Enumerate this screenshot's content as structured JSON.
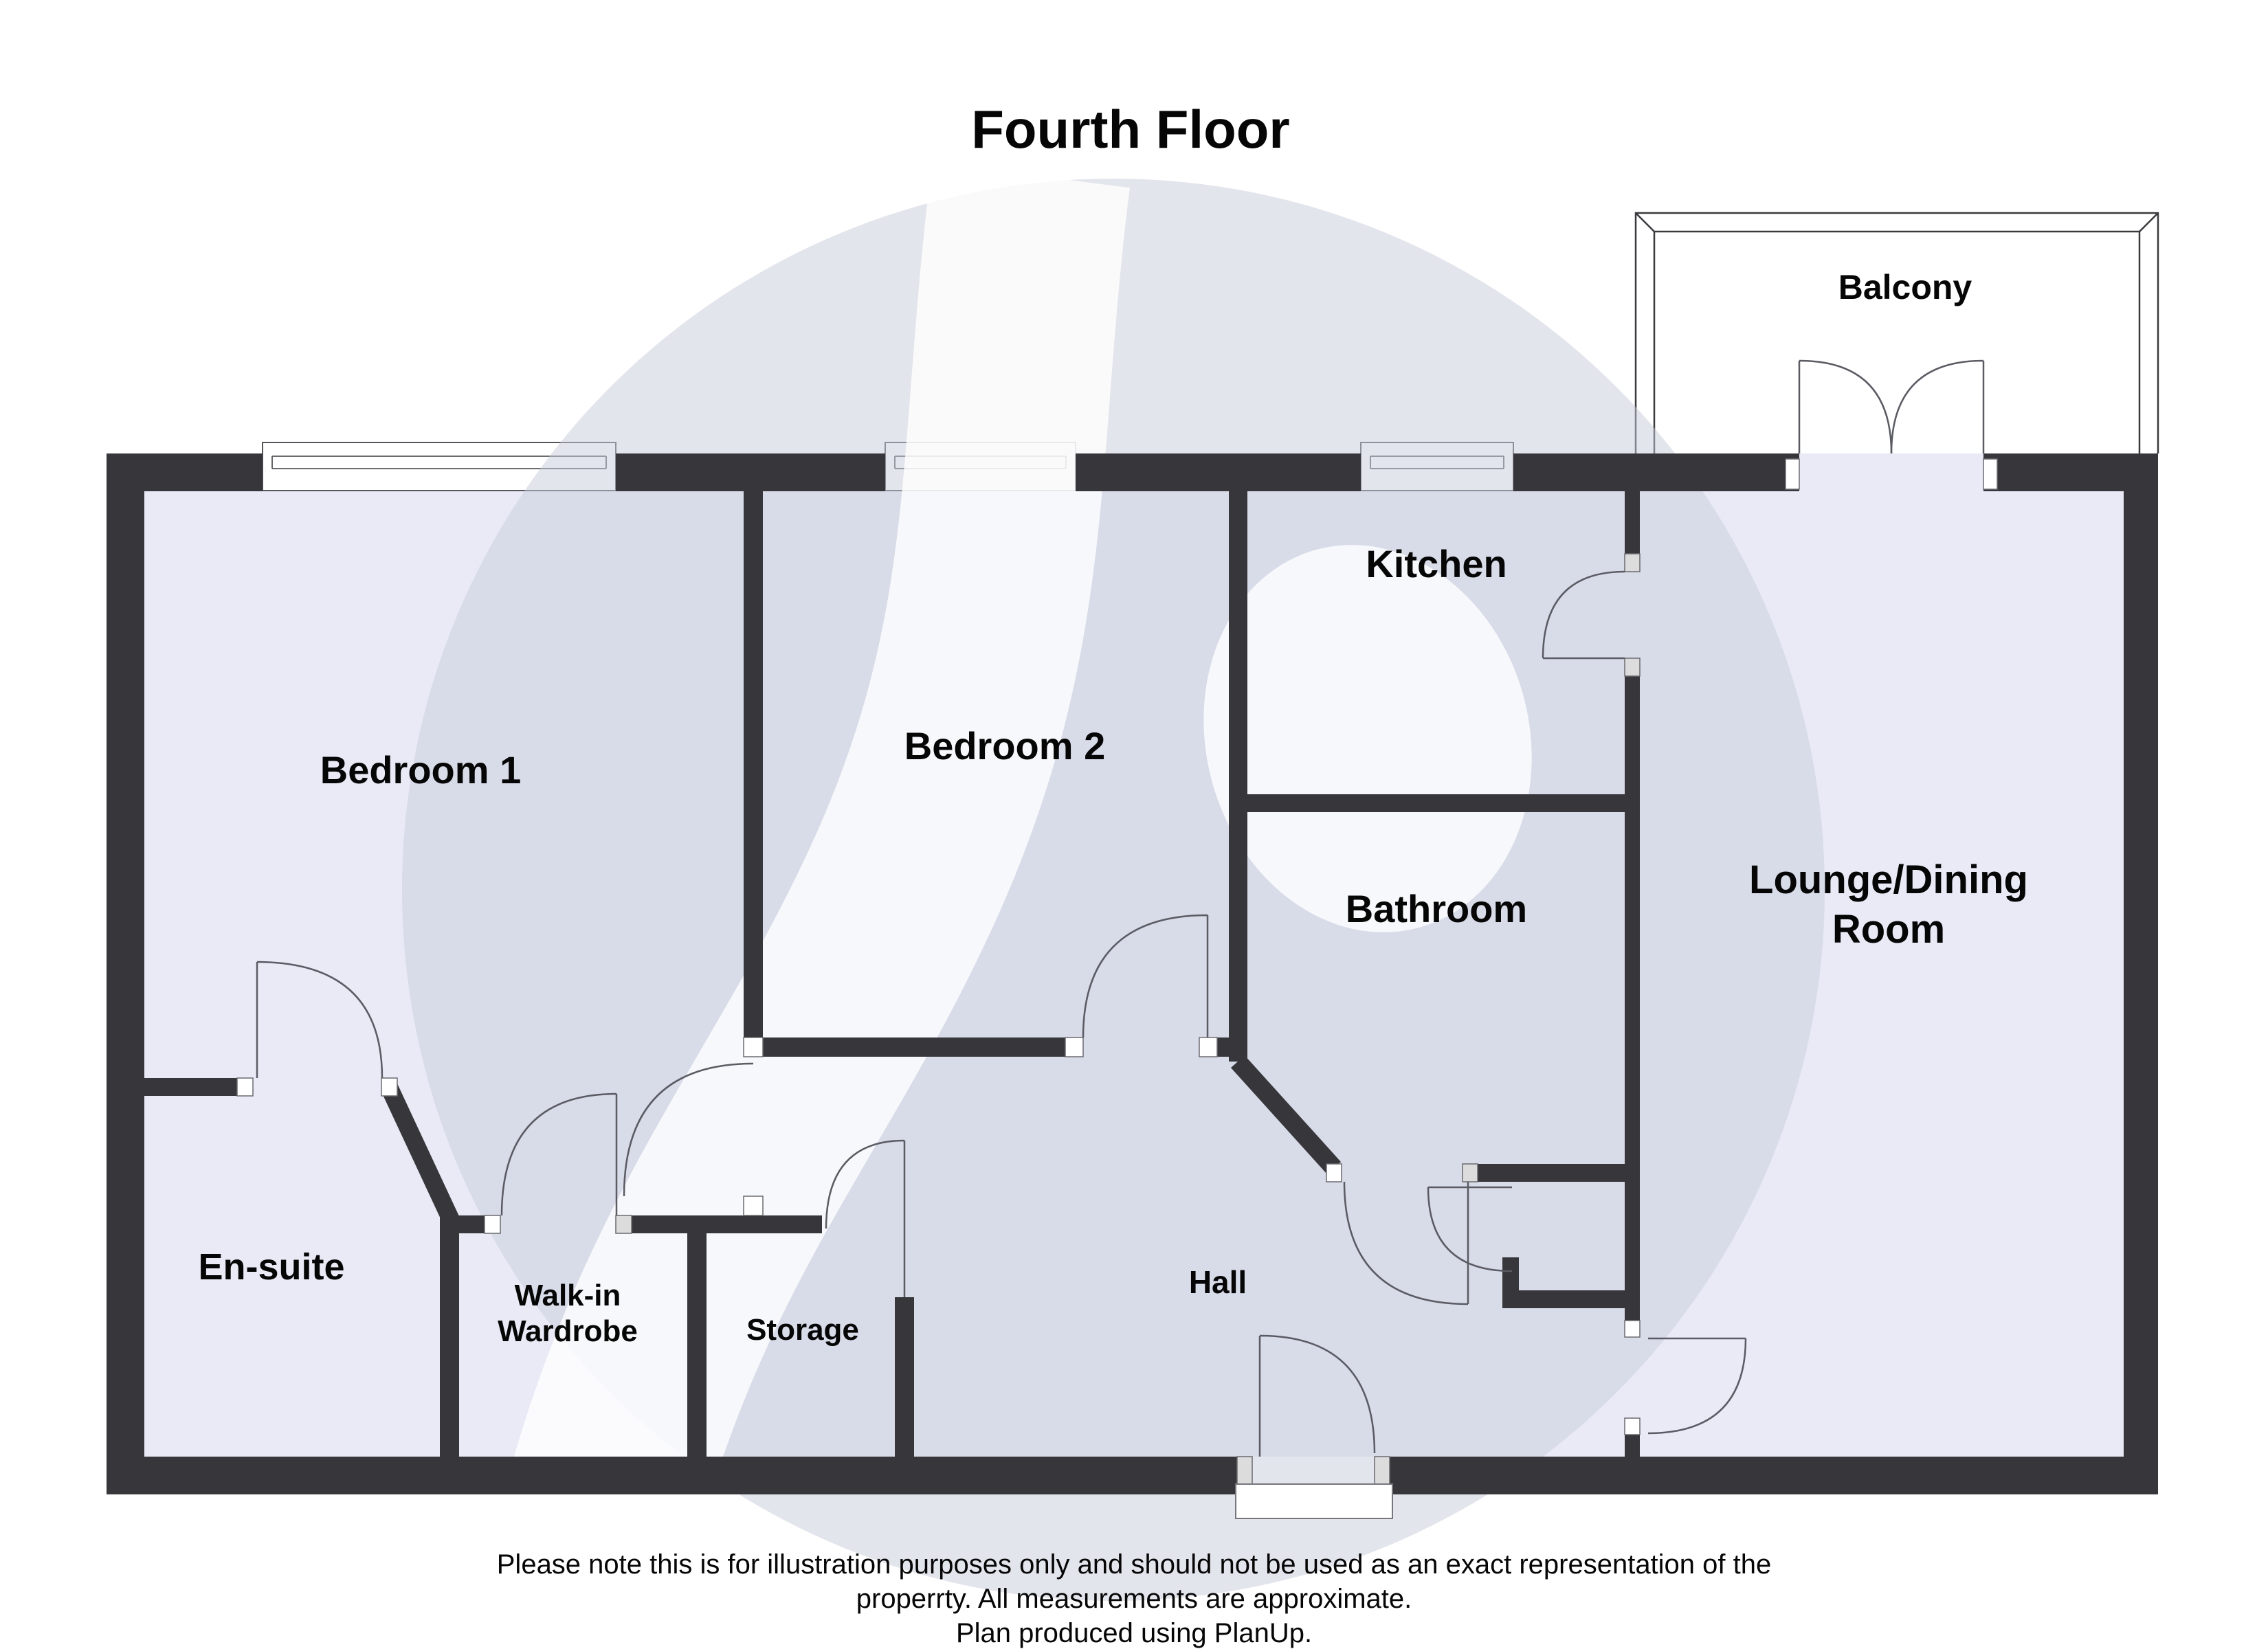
{
  "title": "Fourth Floor",
  "rooms": {
    "balcony": "Balcony",
    "kitchen": "Kitchen",
    "bedroom1": "Bedroom 1",
    "bedroom2": "Bedroom 2",
    "bathroom": "Bathroom",
    "lounge_line1": "Lounge/Dining",
    "lounge_line2": "Room",
    "ensuite": "En-suite",
    "wardrobe_line1": "Walk-in",
    "wardrobe_line2": "Wardrobe",
    "storage": "Storage",
    "hall": "Hall"
  },
  "footer": {
    "line1": "Please note this is for illustration purposes only and should not be used as an exact representation of the",
    "line2": "properrty. All measurements are approximate.",
    "line3": "Plan produced using PlanUp."
  },
  "colors": {
    "wall": "#37373B",
    "floor": "#E9EAF6",
    "watermark": "#C8CBDA",
    "door_arc": "#5A5B63",
    "text": "#060606",
    "background": "#FFFFFF"
  }
}
